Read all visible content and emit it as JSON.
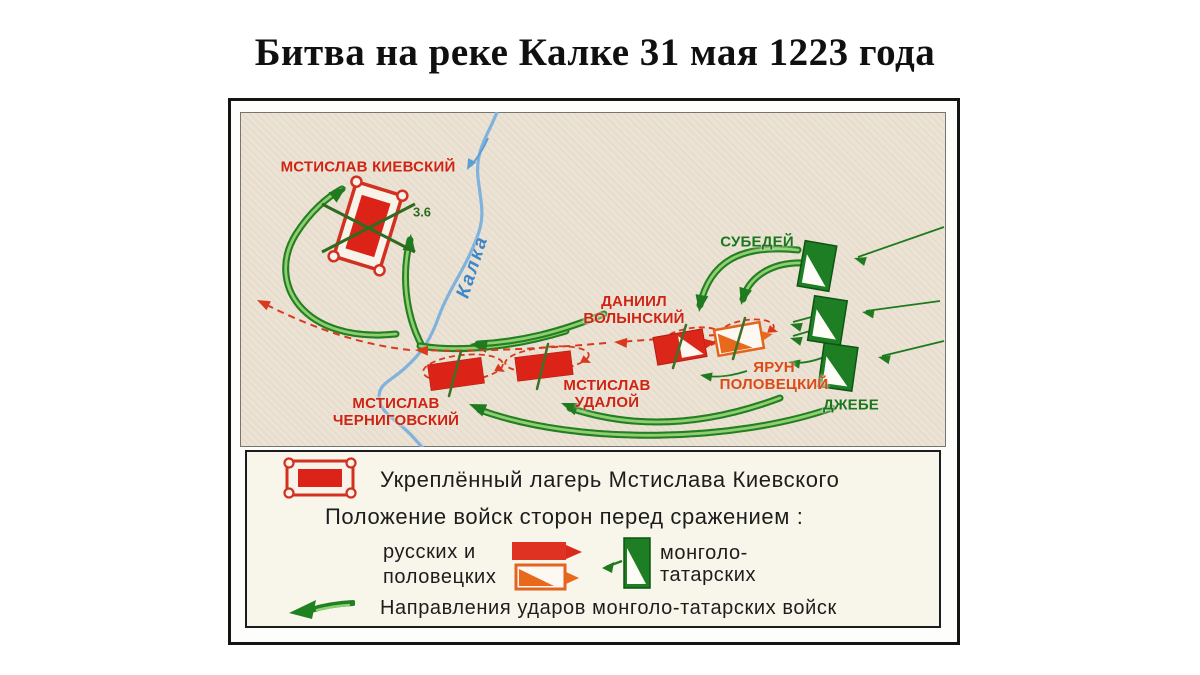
{
  "title": "Битва на реке Калке 31 мая 1223 года",
  "map": {
    "river_label": "Калка",
    "camp_note": "3.6",
    "commanders": [
      {
        "id": "mstislav-kievsky",
        "line1": "МСТИСЛАВ КИЕВСКИЙ",
        "line2": "",
        "side": "russian"
      },
      {
        "id": "subedey",
        "line1": "СУБЕДЕЙ",
        "line2": "",
        "side": "mongol"
      },
      {
        "id": "daniil-volynsky",
        "line1": "ДАНИИЛ",
        "line2": "ВОЛЫНСКИЙ",
        "side": "russian"
      },
      {
        "id": "yarun-polovetsky",
        "line1": "ЯРУН",
        "line2": "ПОЛОВЕЦКИЙ",
        "side": "polovtsian"
      },
      {
        "id": "dzhebe",
        "line1": "ДЖЕБЕ",
        "line2": "",
        "side": "mongol"
      },
      {
        "id": "mstislav-udaloy",
        "line1": "МСТИСЛАВ",
        "line2": "УДАЛОЙ",
        "side": "russian"
      },
      {
        "id": "mstislav-chernigovsky",
        "line1": "МСТИСЛАВ",
        "line2": "ЧЕРНИГОВСКИЙ",
        "side": "russian"
      }
    ]
  },
  "legend": {
    "camp_label": "Укреплённый лагерь Мстислава Киевского",
    "positions_label": "Положение войск сторон перед сражением :",
    "russian_label_line1": "русских и",
    "russian_label_line2": "половецких",
    "mongol_label_line1": "монголо-",
    "mongol_label_line2": "татарских",
    "directions_label": "Направления ударов монголо-татарских войск",
    "icons": {
      "camp": "fortified-camp-icon",
      "russian": "russian-unit-flag-icon",
      "polovtsian": "polovtsian-unit-flag-icon",
      "mongol": "mongol-unit-flag-icon",
      "attack": "mongol-attack-arrow-icon"
    }
  },
  "colors": {
    "russian_red": "#dc2318",
    "polovtsian_orange": "#e2641e",
    "mongol_green": "#1d7e23",
    "label_red": "#cf2414",
    "label_green": "#1b761d",
    "river_blue": "#7fb2dc",
    "map_bg": "#ebe3d4",
    "legend_bg": "#f8f5eb"
  }
}
